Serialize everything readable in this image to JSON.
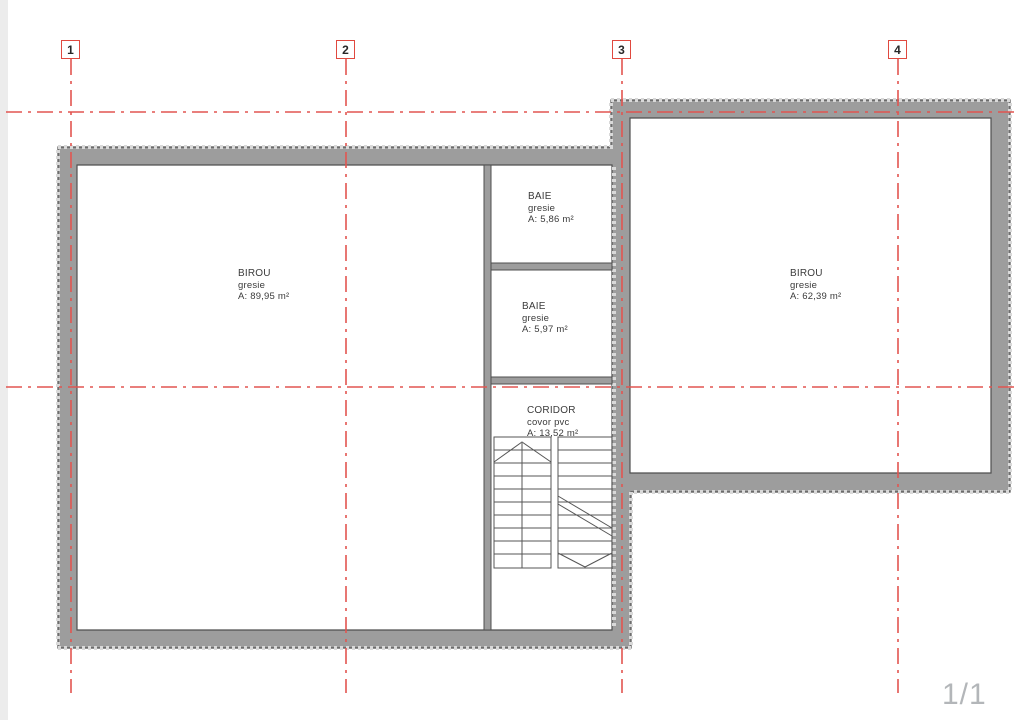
{
  "page": {
    "indicator": "1/1"
  },
  "colors": {
    "grid_red": "#e25550",
    "wall_fill": "#9d9d9d",
    "wall_outline": "#4f4f4f",
    "label_text": "#3b3b3b",
    "indicator_gray": "#b3b6b9"
  },
  "grid_markers": [
    {
      "label": "1"
    },
    {
      "label": "2"
    },
    {
      "label": "3"
    },
    {
      "label": "4"
    }
  ],
  "rooms": [
    {
      "name": "BIROU",
      "finish": "gresie",
      "area": "A: 89,95 m²"
    },
    {
      "name": "BAIE",
      "finish": "gresie",
      "area": "A: 5,86 m²"
    },
    {
      "name": "BAIE",
      "finish": "gresie",
      "area": "A: 5,97 m²"
    },
    {
      "name": "CORIDOR",
      "finish": "covor pvc",
      "area": "A: 13,52 m²"
    },
    {
      "name": "BIROU",
      "finish": "gresie",
      "area": "A: 62,39 m²"
    }
  ]
}
